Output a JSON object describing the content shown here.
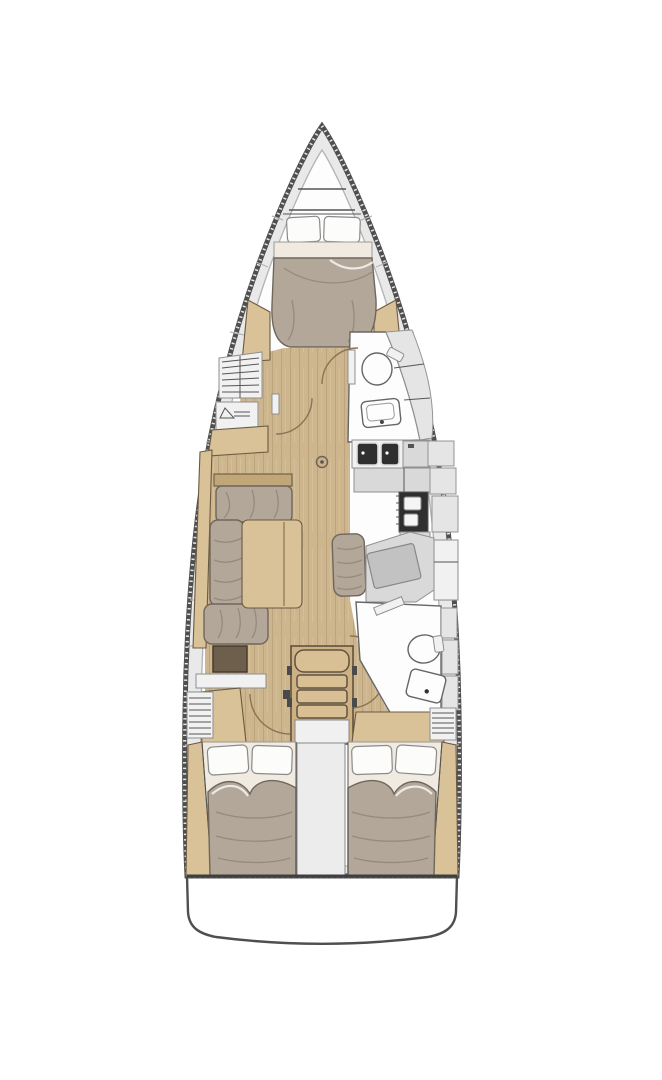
{
  "diagram": {
    "type": "sailboat-interior-floor-plan",
    "orientation": "bow-up",
    "areas": [
      {
        "name": "anchor-locker"
      },
      {
        "name": "forward-cabin",
        "fixtures": [
          "double-berth",
          "pillows",
          "shelf-unit",
          "hanging-locker"
        ]
      },
      {
        "name": "forward-head",
        "fixtures": [
          "toilet",
          "sink",
          "shower-lockers",
          "door"
        ]
      },
      {
        "name": "galley",
        "fixtures": [
          "double-sink",
          "counter",
          "stove-oven",
          "hull-lockers"
        ]
      },
      {
        "name": "salon",
        "fixtures": [
          "l-settee",
          "table",
          "chaise",
          "storage-box"
        ]
      },
      {
        "name": "nav-station",
        "fixtures": [
          "seat",
          "chart-table",
          "cabinet"
        ]
      },
      {
        "name": "companionway",
        "fixtures": [
          "stairs",
          "landing",
          "walkway"
        ]
      },
      {
        "name": "aft-head",
        "fixtures": [
          "toilet",
          "sink",
          "lockers",
          "door"
        ]
      },
      {
        "name": "aft-cabin-port",
        "fixtures": [
          "double-berth",
          "pillows",
          "vent-locker"
        ]
      },
      {
        "name": "aft-cabin-starboard",
        "fixtures": [
          "double-berth",
          "pillows",
          "vent-locker"
        ]
      },
      {
        "name": "transom"
      }
    ],
    "fixtures_of_note": [
      "mast-post",
      "door-swing-arcs"
    ]
  },
  "colors": {
    "bg": "#ffffff",
    "hull_line": "#4f4f4f",
    "deck": "#e9e9e9",
    "interior": "#fdfdfd",
    "floor_wood": "#cdb58d",
    "furniture_wood": "#d9c198",
    "wood_dark": "#6b5a42",
    "cushion": "#b3a79a",
    "cushion_edge": "#6f675c",
    "bedding": "#f0eae0",
    "pillow": "#fcfcfb",
    "counter": "#d9d9d9",
    "locker": "#e5e5e5",
    "appliance": "#2f2f2f",
    "fixture": "#fdfdfd",
    "door_arc": "#8b7355"
  }
}
